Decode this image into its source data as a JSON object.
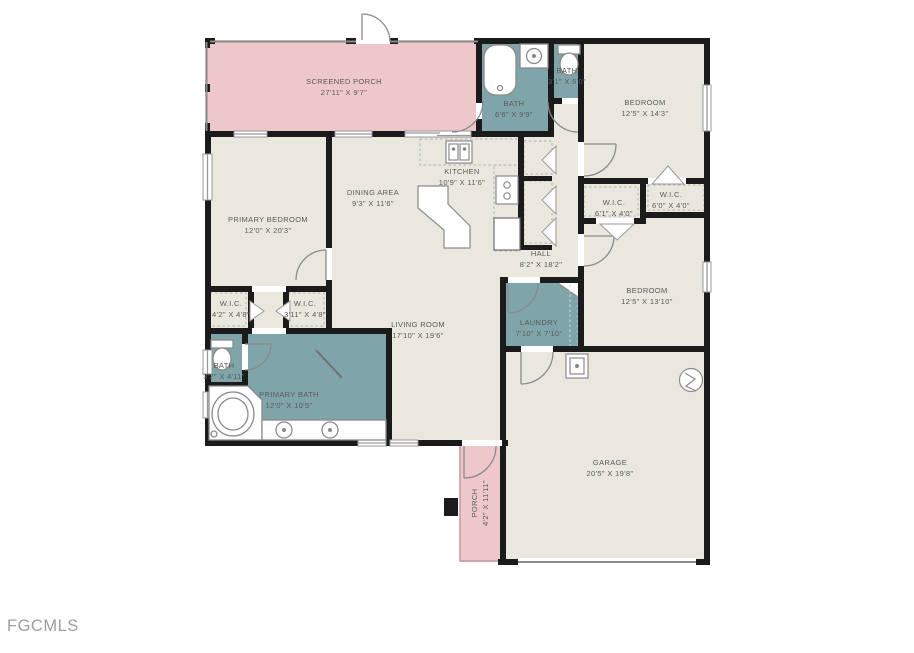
{
  "page": {
    "watermark": "FGCMLS"
  },
  "colors": {
    "background": "#ffffff",
    "floor_beige": "#e9e7de",
    "porch_pink": "#eec7cb",
    "wet_room_teal": "#7fa5aa",
    "wall_black": "#1b1b1b",
    "fixture_outline_gray": "#8a8a8a",
    "label_text_gray": "#5a5a5a",
    "watermark_gray": "#9e9e9e"
  },
  "rooms": [
    {
      "id": "screened-porch",
      "name": "SCREENED PORCH",
      "dims": "27'11\" X 9'7\""
    },
    {
      "id": "bath-main",
      "name": "BATH",
      "dims": "6'6\" X 9'9\""
    },
    {
      "id": "bath-2",
      "name": "BATH",
      "dims": "3'1\" X 6'0\""
    },
    {
      "id": "bedroom-ne",
      "name": "BEDROOM",
      "dims": "12'5\" X 14'3\""
    },
    {
      "id": "primary-bedroom",
      "name": "PRIMARY BEDROOM",
      "dims": "12'0\" X 20'3\""
    },
    {
      "id": "dining-area",
      "name": "DINING AREA",
      "dims": "9'3\" X 11'6\""
    },
    {
      "id": "kitchen",
      "name": "KITCHEN",
      "dims": "10'9\" X 11'6\""
    },
    {
      "id": "hall",
      "name": "HALL",
      "dims": "8'2\" X 18'2\""
    },
    {
      "id": "wic-hall-left",
      "name": "W.I.C.",
      "dims": "6'1\" X 4'0\""
    },
    {
      "id": "wic-hall-right",
      "name": "W.I.C.",
      "dims": "6'0\" X 4'0\""
    },
    {
      "id": "bedroom-se",
      "name": "BEDROOM",
      "dims": "12'5\" X 13'10\""
    },
    {
      "id": "laundry",
      "name": "LAUNDRY",
      "dims": "7'10\" X 7'10\""
    },
    {
      "id": "living-room",
      "name": "LIVING ROOM",
      "dims": "17'10\" X 19'6\""
    },
    {
      "id": "wic-primary-a",
      "name": "W.I.C.",
      "dims": "4'2\" X 4'8\""
    },
    {
      "id": "wic-primary-b",
      "name": "W.I.C.",
      "dims": "3'11\" X 4'8\""
    },
    {
      "id": "bath-primary-sm",
      "name": "BATH",
      "dims": "3'2\" X 4'11\""
    },
    {
      "id": "primary-bath",
      "name": "PRIMARY BATH",
      "dims": "12'0\" X 10'5\""
    },
    {
      "id": "garage",
      "name": "GARAGE",
      "dims": "20'5\" X 19'8\""
    },
    {
      "id": "porch",
      "name": "PORCH",
      "dims": "4'2\" X 11'11\""
    }
  ],
  "fixtures": [
    "bathtub",
    "vanity-sink",
    "toilet",
    "corner-tub",
    "double-vanity",
    "kitchen-sink",
    "stove",
    "refrigerator",
    "kitchen-island",
    "utility-sink",
    "water-heater",
    "garage-door",
    "door-swing",
    "bifold-closet-door",
    "window"
  ]
}
